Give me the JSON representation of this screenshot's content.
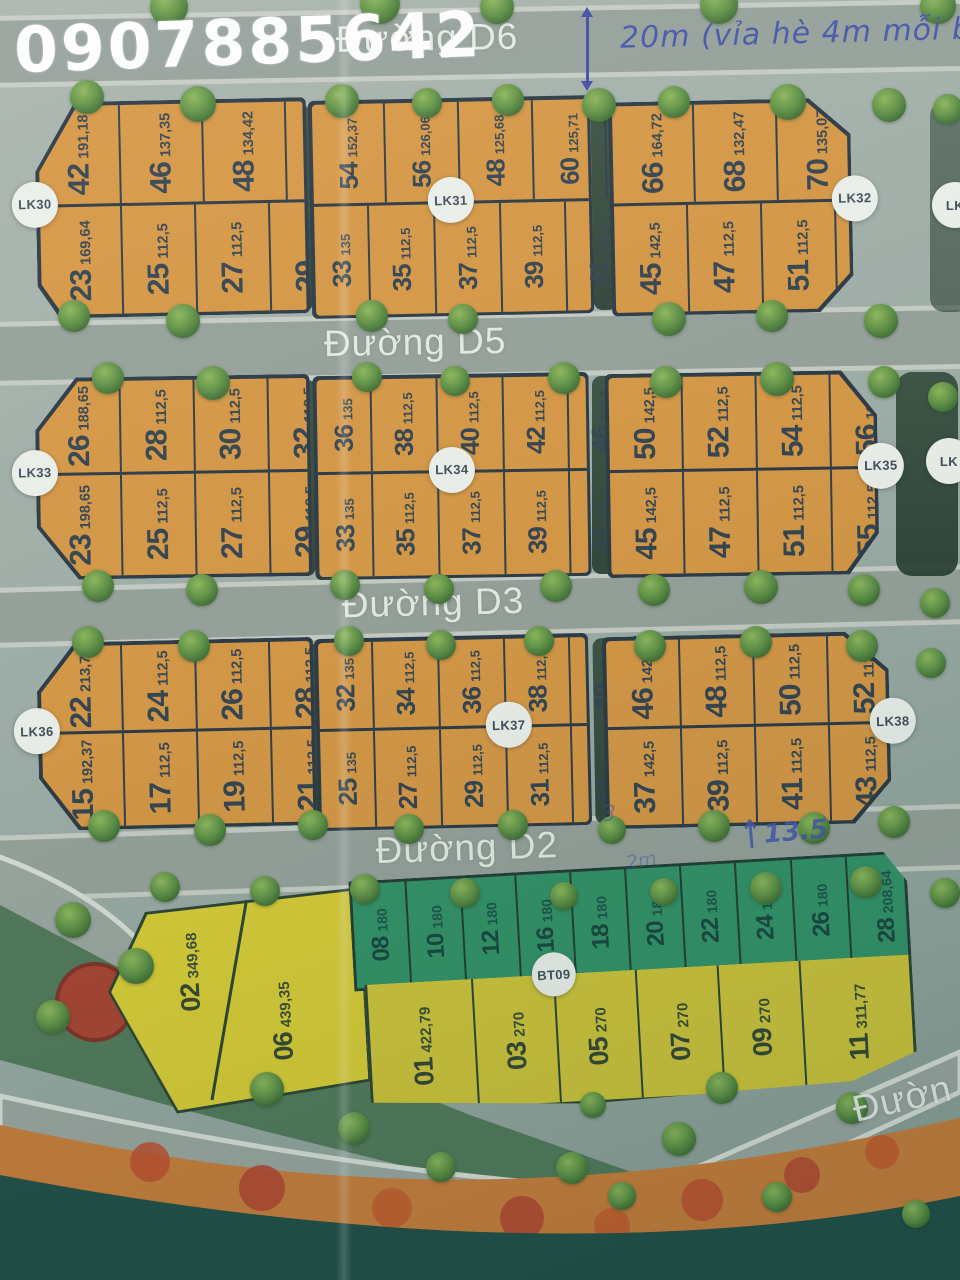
{
  "watermark": {
    "phone": "0907885642"
  },
  "streets": {
    "d6": "Đường D6",
    "d5": "Đường D5",
    "d3": "Đường D3",
    "d2": "Đường D2",
    "bottom_right_partial": "Đườn"
  },
  "annotations": {
    "top_dimension": "20m (vỉa hè 4m mỗi b",
    "top_dimension_sup": "2",
    "d2_dimension": "13.5",
    "d2_scribble_1": "3",
    "d2_scribble_2": "2m"
  },
  "partials": {
    "right_row1": "LK",
    "right_row2": "LK"
  },
  "colors": {
    "plot_orange": "#d79540",
    "plot_green": "#2e9064",
    "plot_yellow": "#cfc335",
    "outline_dark": "#263440",
    "handwriting_blue": "#4152a8",
    "water_teal": "#1d4a43",
    "flower_orange": "#c97a35"
  },
  "blocks": [
    {
      "label": "LK30",
      "top": [
        {
          "n": "42",
          "a": "191,18"
        },
        {
          "n": "46",
          "a": "137,35"
        },
        {
          "n": "48",
          "a": "134,42"
        },
        {
          "n": "50",
          "a": "131,92"
        },
        {
          "n": "52",
          "a": "155,6"
        }
      ],
      "bottom": [
        {
          "n": "23",
          "a": "169,64"
        },
        {
          "n": "25",
          "a": "112,5"
        },
        {
          "n": "27",
          "a": "112,5"
        },
        {
          "n": "29",
          "a": "112,5"
        },
        {
          "n": "31",
          "a": "135"
        }
      ]
    },
    {
      "label": "LK31",
      "top": [
        {
          "n": "54",
          "a": "152,37"
        },
        {
          "n": "56",
          "a": "126,06"
        },
        {
          "n": "48",
          "a": "125,68"
        },
        {
          "n": "60",
          "a": "125,71"
        },
        {
          "n": "62",
          "a": "126,16"
        },
        {
          "n": "64",
          "a": "152,58"
        }
      ],
      "bottom": [
        {
          "n": "33",
          "a": "135"
        },
        {
          "n": "35",
          "a": "112,5"
        },
        {
          "n": "37",
          "a": "112,5"
        },
        {
          "n": "39",
          "a": "112,5"
        },
        {
          "n": "41",
          "a": "112,5"
        },
        {
          "n": "43",
          "a": "135"
        }
      ]
    },
    {
      "label": "LK32",
      "top": [
        {
          "n": "66",
          "a": "164,72"
        },
        {
          "n": "68",
          "a": "132,47"
        },
        {
          "n": "70",
          "a": "135,07"
        },
        {
          "n": "72",
          "a": "138,09"
        },
        {
          "n": "74",
          "a": "184,61"
        }
      ],
      "bottom": [
        {
          "n": "45",
          "a": "142,5"
        },
        {
          "n": "47",
          "a": "112,5"
        },
        {
          "n": "51",
          "a": "112,5"
        },
        {
          "n": "55",
          "a": "112,5"
        },
        {
          "n": "57",
          "a": "162,58"
        }
      ]
    },
    {
      "label": "LK33",
      "top": [
        {
          "n": "26",
          "a": "188,65"
        },
        {
          "n": "28",
          "a": "112,5"
        },
        {
          "n": "30",
          "a": "112,5"
        },
        {
          "n": "32",
          "a": "112,5"
        },
        {
          "n": "34",
          "a": "135"
        }
      ],
      "bottom": [
        {
          "n": "23",
          "a": "198,65"
        },
        {
          "n": "25",
          "a": "112,5"
        },
        {
          "n": "27",
          "a": "112,5"
        },
        {
          "n": "29",
          "a": "112,5"
        },
        {
          "n": "31",
          "a": "135"
        }
      ]
    },
    {
      "label": "LK34",
      "top": [
        {
          "n": "36",
          "a": "135"
        },
        {
          "n": "38",
          "a": "112,5"
        },
        {
          "n": "40",
          "a": "112,5"
        },
        {
          "n": "42",
          "a": "112,5"
        },
        {
          "n": "46",
          "a": "112,5"
        },
        {
          "n": "48",
          "a": "135"
        }
      ],
      "bottom": [
        {
          "n": "33",
          "a": "135"
        },
        {
          "n": "35",
          "a": "112,5"
        },
        {
          "n": "37",
          "a": "112,5"
        },
        {
          "n": "39",
          "a": "112,5"
        },
        {
          "n": "41",
          "a": "112,5"
        },
        {
          "n": "43",
          "a": "135"
        }
      ]
    },
    {
      "label": "LK35",
      "top": [
        {
          "n": "50",
          "a": "142,5"
        },
        {
          "n": "52",
          "a": "112,5"
        },
        {
          "n": "54",
          "a": "112,5"
        },
        {
          "n": "56",
          "a": "112,5"
        },
        {
          "n": "58",
          "a": "179,91"
        }
      ],
      "bottom": [
        {
          "n": "45",
          "a": "142,5"
        },
        {
          "n": "47",
          "a": "112,5"
        },
        {
          "n": "51",
          "a": "112,5"
        },
        {
          "n": "55",
          "a": "112,5"
        },
        {
          "n": "57",
          "a": "189,03"
        }
      ]
    },
    {
      "label": "LK36",
      "top": [
        {
          "n": "22",
          "a": "213,71"
        },
        {
          "n": "24",
          "a": "112,5"
        },
        {
          "n": "26",
          "a": "112,5"
        },
        {
          "n": "28",
          "a": "112,5"
        },
        {
          "n": "30",
          "a": "135"
        }
      ],
      "bottom": [
        {
          "n": "15",
          "a": "192,37"
        },
        {
          "n": "17",
          "a": "112,5"
        },
        {
          "n": "19",
          "a": "112,5"
        },
        {
          "n": "21",
          "a": "112,5"
        },
        {
          "n": "23",
          "a": "135"
        }
      ]
    },
    {
      "label": "LK37",
      "top": [
        {
          "n": "32",
          "a": "135"
        },
        {
          "n": "34",
          "a": "112,5"
        },
        {
          "n": "36",
          "a": "112,5"
        },
        {
          "n": "38",
          "a": "112,5"
        },
        {
          "n": "40",
          "a": "112,5"
        },
        {
          "n": "42",
          "a": "135"
        }
      ],
      "bottom": [
        {
          "n": "25",
          "a": "135"
        },
        {
          "n": "27",
          "a": "112,5"
        },
        {
          "n": "29",
          "a": "112,5"
        },
        {
          "n": "31",
          "a": "112,5"
        },
        {
          "n": "33",
          "a": "112,5"
        },
        {
          "n": "35",
          "a": "135"
        }
      ]
    },
    {
      "label": "LK38",
      "top": [
        {
          "n": "46",
          "a": "142,5"
        },
        {
          "n": "48",
          "a": "112,5"
        },
        {
          "n": "50",
          "a": "112,5"
        },
        {
          "n": "52",
          "a": "112,5"
        },
        {
          "n": "54",
          "a": "206,36"
        }
      ],
      "bottom": [
        {
          "n": "37",
          "a": "142,5"
        },
        {
          "n": "39",
          "a": "112,5"
        },
        {
          "n": "41",
          "a": "112,5"
        },
        {
          "n": "43",
          "a": "112,5"
        },
        {
          "n": "45",
          "a": "215,49"
        }
      ]
    }
  ],
  "bt_block": {
    "label": "BT09",
    "wedge": [
      {
        "n": "02",
        "a": "349,68"
      },
      {
        "n": "06",
        "a": "439,35"
      }
    ],
    "green_row": [
      {
        "n": "08",
        "a": "180"
      },
      {
        "n": "10",
        "a": "180"
      },
      {
        "n": "12",
        "a": "180"
      },
      {
        "n": "16",
        "a": "180"
      },
      {
        "n": "18",
        "a": "180"
      },
      {
        "n": "20",
        "a": "180"
      },
      {
        "n": "22",
        "a": "180"
      },
      {
        "n": "24",
        "a": "180"
      },
      {
        "n": "26",
        "a": "180"
      },
      {
        "n": "28",
        "a": "208,64"
      }
    ],
    "yellow_row": [
      {
        "n": "01",
        "a": "422,79"
      },
      {
        "n": "03",
        "a": "270"
      },
      {
        "n": "05",
        "a": "270"
      },
      {
        "n": "07",
        "a": "270"
      },
      {
        "n": "09",
        "a": "270"
      },
      {
        "n": "11",
        "a": "311,77"
      }
    ]
  }
}
